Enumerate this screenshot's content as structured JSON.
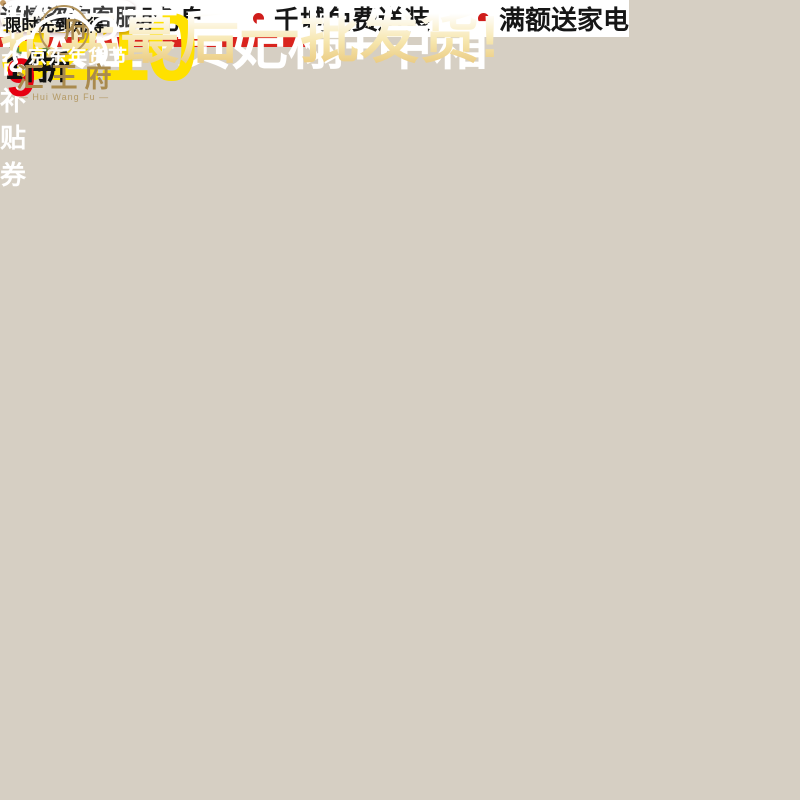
{
  "brand": {
    "logo_cn": "汇王府",
    "logo_en": "— Hui Wang Fu —",
    "emblem_char": "府"
  },
  "header": {
    "festival_badge": "京东年货节",
    "headline": "抢年蕞后一批发货!"
  },
  "coupon": {
    "title": "平台补贴券",
    "qty": "1件",
    "discount": "9",
    "unit": "折",
    "note": "限时先到先得"
  },
  "promo": {
    "gift": "咨询下单送实木熊猫凳",
    "bullets": [
      "三期免息",
      "千城免费送装",
      "满额送家电"
    ]
  },
  "price": {
    "amount": "3210"
  },
  "footer": {
    "config": "5人位+贵妃榻+中箱",
    "cta": "详情咨询客服"
  },
  "colors": {
    "jd_red": "#e1251b",
    "strip_red": "#d2211f",
    "circle_red": "#e60012",
    "price_yellow": "#ffe100",
    "banner_gold": "#e5bf6e",
    "brand_gold": "#a98a4e",
    "cushion_blue": "#7b9cb4"
  }
}
